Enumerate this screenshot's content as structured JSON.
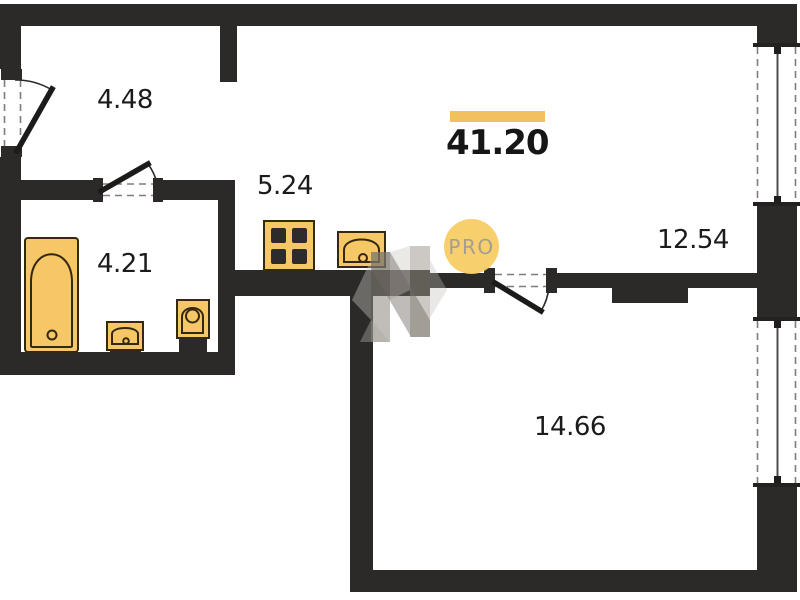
{
  "plan": {
    "total_area": "41.20",
    "watermark_text": "PRO",
    "rooms": [
      {
        "name": "hallway",
        "area": "4.48"
      },
      {
        "name": "bathroom",
        "area": "4.21"
      },
      {
        "name": "kitchen",
        "area": "5.24"
      },
      {
        "name": "living-area",
        "area": "12.54"
      },
      {
        "name": "room",
        "area": "14.66"
      }
    ],
    "fixtures": [
      "bathtub",
      "sink",
      "toilet",
      "stove",
      "kitchen-sink"
    ],
    "doors": [
      "entry-door",
      "bathroom-door",
      "room-door"
    ],
    "windows": [
      "window-right-top",
      "window-right-bottom"
    ]
  },
  "colors": {
    "wall": "#2b2a28",
    "accent": "#f2c05e",
    "fixture_fill": "#f6c767",
    "fixture_stroke": "#342910",
    "watermark_circle": "#f8cc63",
    "watermark_text": "#9d968b",
    "label": "#1b1b1b"
  }
}
